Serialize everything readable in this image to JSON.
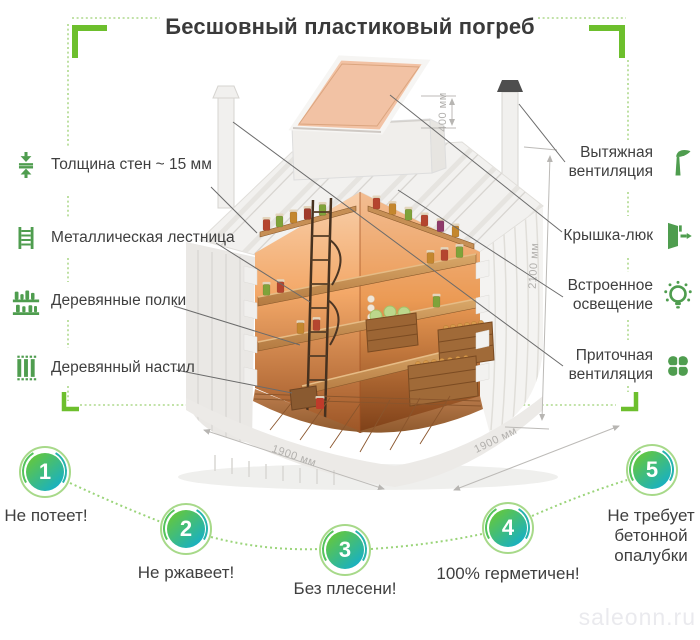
{
  "title": "Бесшовный пластиковый погреб",
  "left_features": [
    {
      "icon": "wall-thickness-icon",
      "label": "Толщина стен ~ 15 мм"
    },
    {
      "icon": "ladder-icon",
      "label": "Металлическая лестница"
    },
    {
      "icon": "shelves-icon",
      "label": "Деревянные полки"
    },
    {
      "icon": "decking-icon",
      "label": "Деревянный настил"
    }
  ],
  "right_features": [
    {
      "icon": "exhaust-vent-icon",
      "label": "Вытяжная вентиляция"
    },
    {
      "icon": "hatch-icon",
      "label": "Крышка-люк"
    },
    {
      "icon": "lighting-icon",
      "label": "Встроенное освещение"
    },
    {
      "icon": "supply-vent-icon",
      "label": "Приточная вентиляция"
    }
  ],
  "dimensions": {
    "hatch_height": "400 мм",
    "body_height": "2100 мм",
    "body_width": "1900 мм",
    "body_depth": "1900 мм"
  },
  "benefits": [
    {
      "number": "1",
      "label": "Не потеет!"
    },
    {
      "number": "2",
      "label": "Не ржавеет!"
    },
    {
      "number": "3",
      "label": "Без плесени!"
    },
    {
      "number": "4",
      "label": "100% герметичен!"
    },
    {
      "number": "5",
      "label": "Не требует бетонной опалубки"
    }
  ],
  "watermark": "saleonn.ru",
  "colors": {
    "accent_green": "#6dbf2d",
    "dotted_green": "#aed98c",
    "icon_green": "#4f9d4f",
    "circle_gradient_start": "#63c73f",
    "circle_gradient_end": "#17b0c4",
    "text_dark": "#3f3f3f",
    "dimension_gray": "#b2b0ad",
    "lid_salmon": "#f2c2a4"
  }
}
